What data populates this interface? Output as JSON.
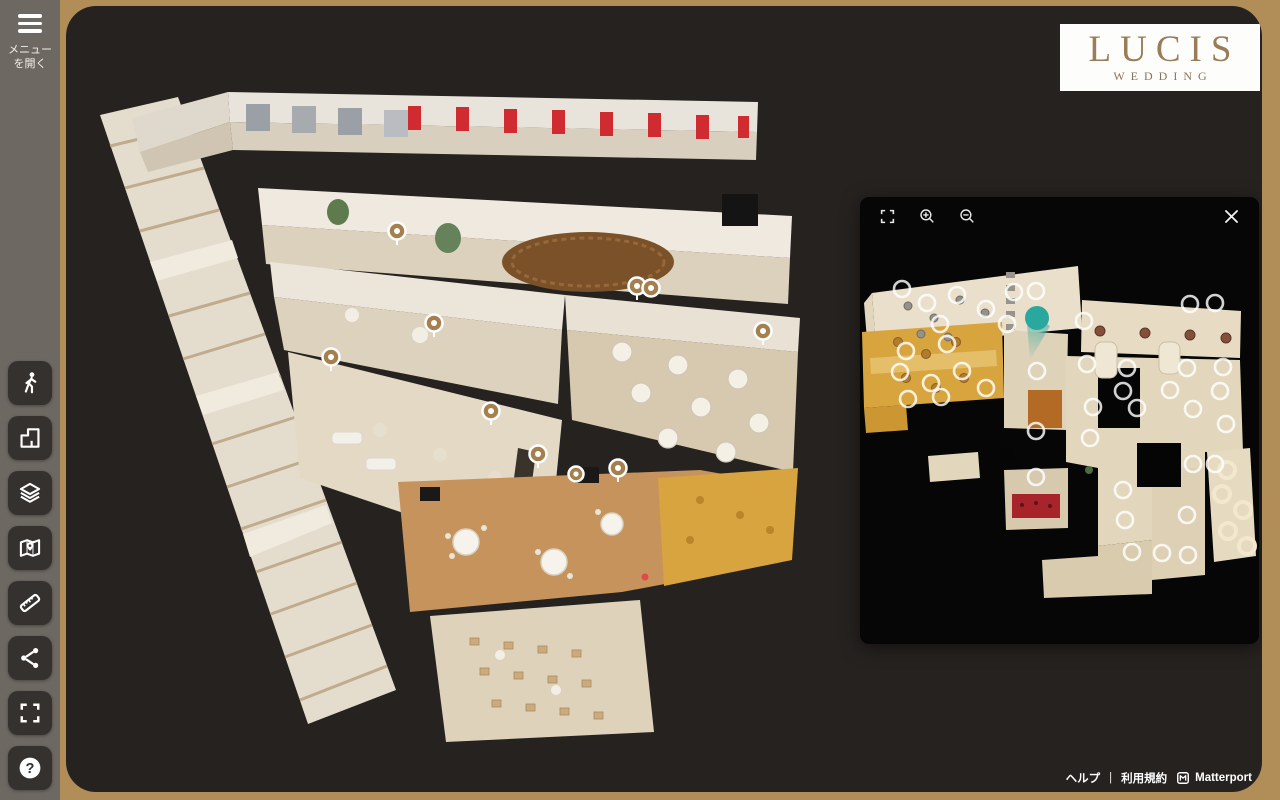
{
  "sidebar": {
    "menu_button": {
      "line1": "メニュー",
      "line2": "を開く"
    },
    "tools": [
      {
        "name": "inside-view"
      },
      {
        "name": "dollhouse-view"
      },
      {
        "name": "floor-levels"
      },
      {
        "name": "floorplan-view"
      },
      {
        "name": "measure"
      },
      {
        "name": "share"
      },
      {
        "name": "fullscreen"
      },
      {
        "name": "help"
      }
    ],
    "help_glyph": "?"
  },
  "logo": {
    "title": "LUCIS",
    "subtitle": "WEDDING"
  },
  "minimap": {
    "controls": {
      "fullscreen": "fullscreen",
      "zoom_in": "zoom-in",
      "zoom_out": "zoom-out",
      "close": "close"
    }
  },
  "footer": {
    "help": "ヘルプ",
    "separator": "|",
    "terms": "利用規約",
    "brand": "Matterport"
  },
  "colors": {
    "frame": "#b18d58",
    "sidebar": "#6e6862",
    "viewer_bg": "#262220",
    "panel_bg": "#060606",
    "logo_text": "#9a7c58",
    "scan_marker": "#a5804e",
    "position_marker": "#2aa79e",
    "accent_red": "#cf2b30",
    "gold_room": "#d8a43e"
  }
}
